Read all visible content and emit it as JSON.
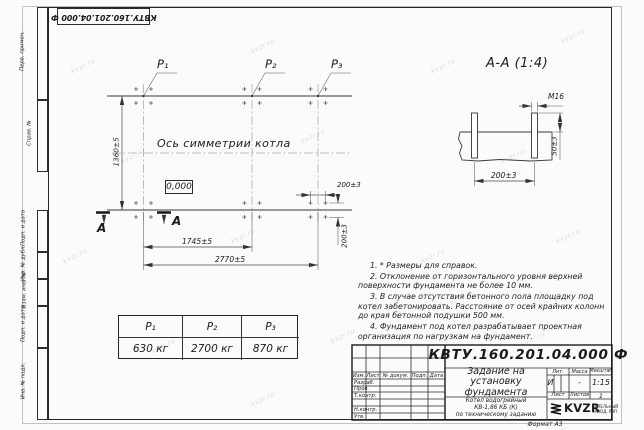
{
  "frame": {
    "stamp_top": "КВТУ.160.201.04.000 Ф",
    "format_note": "Формат А3",
    "side_labels": [
      "Перв. примен.",
      "Справ. №",
      "Подп. и дата",
      "Инв. № дубл.",
      "Взам. инв. №",
      "Подп. и дата",
      "Инв. № подл."
    ]
  },
  "watermark": "kvzr.ru",
  "plan": {
    "p1": "P₁",
    "p2": "P₂",
    "p3": "P₃",
    "symmetry_axis_label": "Ось симметрии котла",
    "elevation_mark": "0,000",
    "dim_height": "1360±5",
    "dim_p1_p2": "1745±5",
    "dim_total": "2770±5",
    "dim_bolt_h": "200±3",
    "dim_bolt_v": "200±3",
    "section_letter_left": "А",
    "section_letter_right": "А"
  },
  "section_view": {
    "title": "А-А (1:4)",
    "thread": "М16",
    "dim_height": "50±3",
    "dim_spacing": "200±3"
  },
  "notes": [
    "1. * Размеры для справок.",
    "2. Отклонение от горизонтального уровня верхней поверхности фундамента не более 10 мм.",
    "3. В случае отсутствия бетонного пола площадку под котел забетонировать. Расстояние от осей крайних колонн до края бетонной подушки 500 мм.",
    "4. Фундамент под котел разрабатывает проектная организация по нагрузкам на фундамент."
  ],
  "load_table": {
    "headers": [
      "P₁",
      "P₂",
      "P₃"
    ],
    "values": [
      "630 кг",
      "2700 кг",
      "870 кг"
    ]
  },
  "title_block": {
    "designation": "КВТУ.160.201.04.000 Ф",
    "doc_title": "Задание на установку фундамента",
    "product_lines": [
      "Котел водогрейный",
      "КВ-1,86 КБ (К)",
      "по техническому заданию"
    ],
    "columns": [
      "Изм.",
      "Лист",
      "№ докум.",
      "Подп.",
      "Дата"
    ],
    "row_labels": [
      "Разраб.",
      "Пров.",
      "Т.контр.",
      "Н.контр.",
      "Утв."
    ],
    "lit_label": "Лит.",
    "mass_label": "Масса",
    "scale_label": "Масштаб",
    "lit_value": "И",
    "mass_value": "-",
    "scale_value": "1:15",
    "sheet_label": "Лист",
    "sheets_label": "Листов",
    "sheets_value": "1",
    "logo_text": "KVZR",
    "logo_caption": [
      "КОТЕЛЬНЫЙ",
      "ЗАВОД, РЭП"
    ]
  }
}
